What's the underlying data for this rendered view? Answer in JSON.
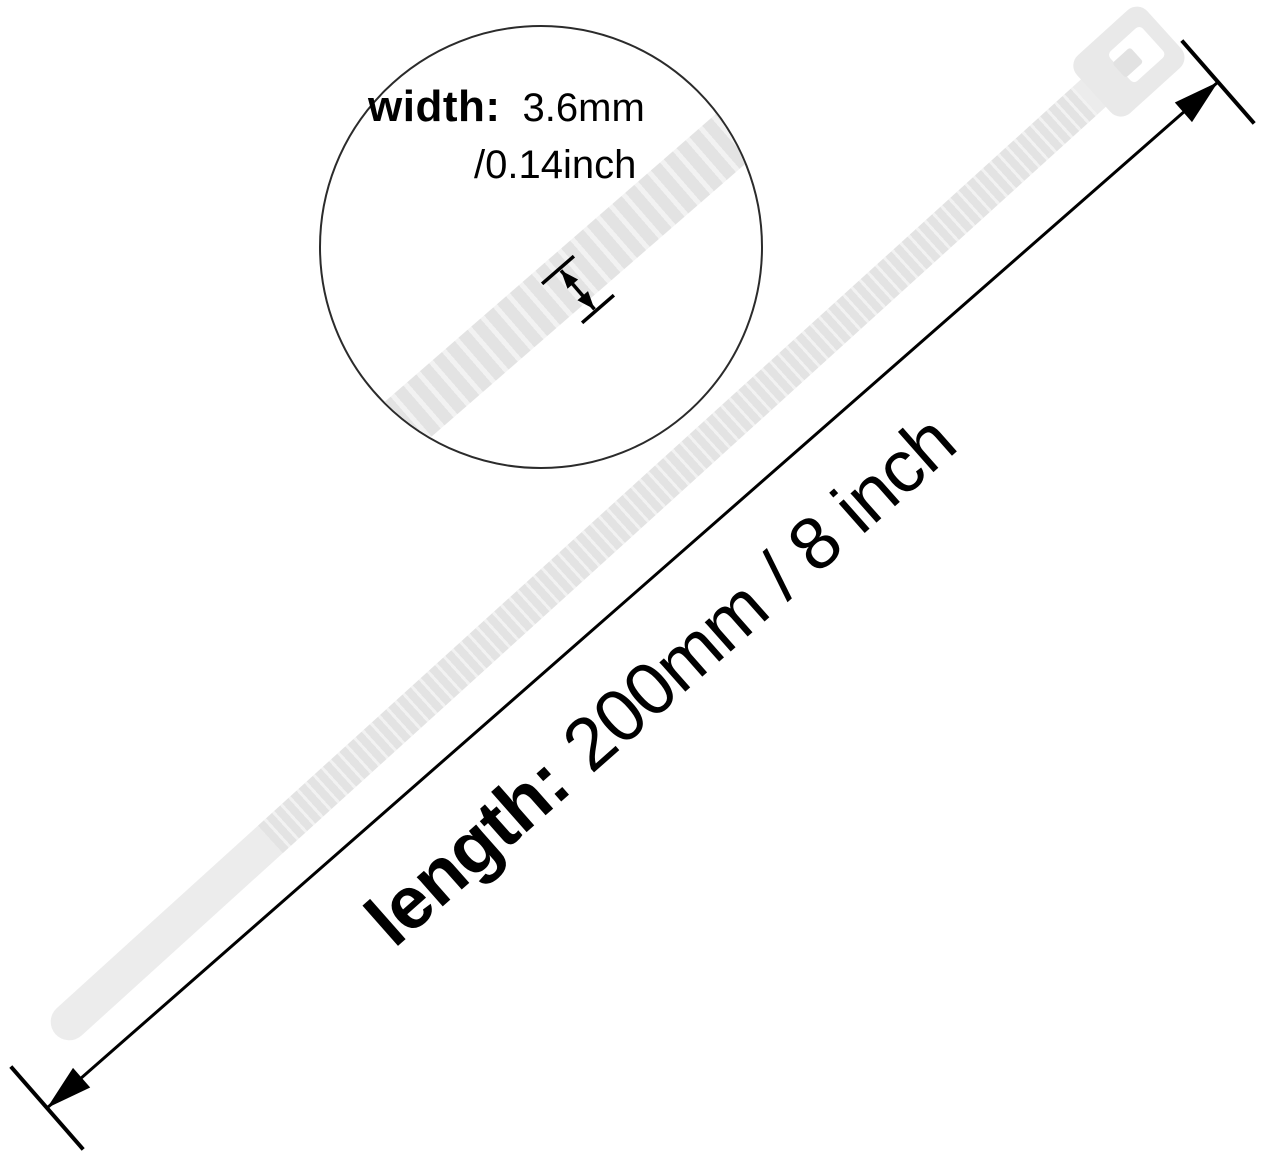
{
  "diagram": {
    "subject": "nylon-cable-tie",
    "magnifier": {
      "width_label": "width:",
      "width_value_mm": "3.6mm",
      "width_value_inch": "/0.14inch"
    },
    "length_annotation": {
      "label": "length:",
      "value": "200mm / 8 inch"
    },
    "colors": {
      "bg": "#ffffff",
      "tie_body": "#ececec",
      "tie_ridge_dark": "#e3e3e3",
      "tie_ridge_light": "#f2f2f2",
      "tie_head": "#e9e9e9",
      "tie_pawl": "#e2e2e2",
      "circle_border": "#2b2b2b",
      "annotation": "#000000"
    }
  }
}
